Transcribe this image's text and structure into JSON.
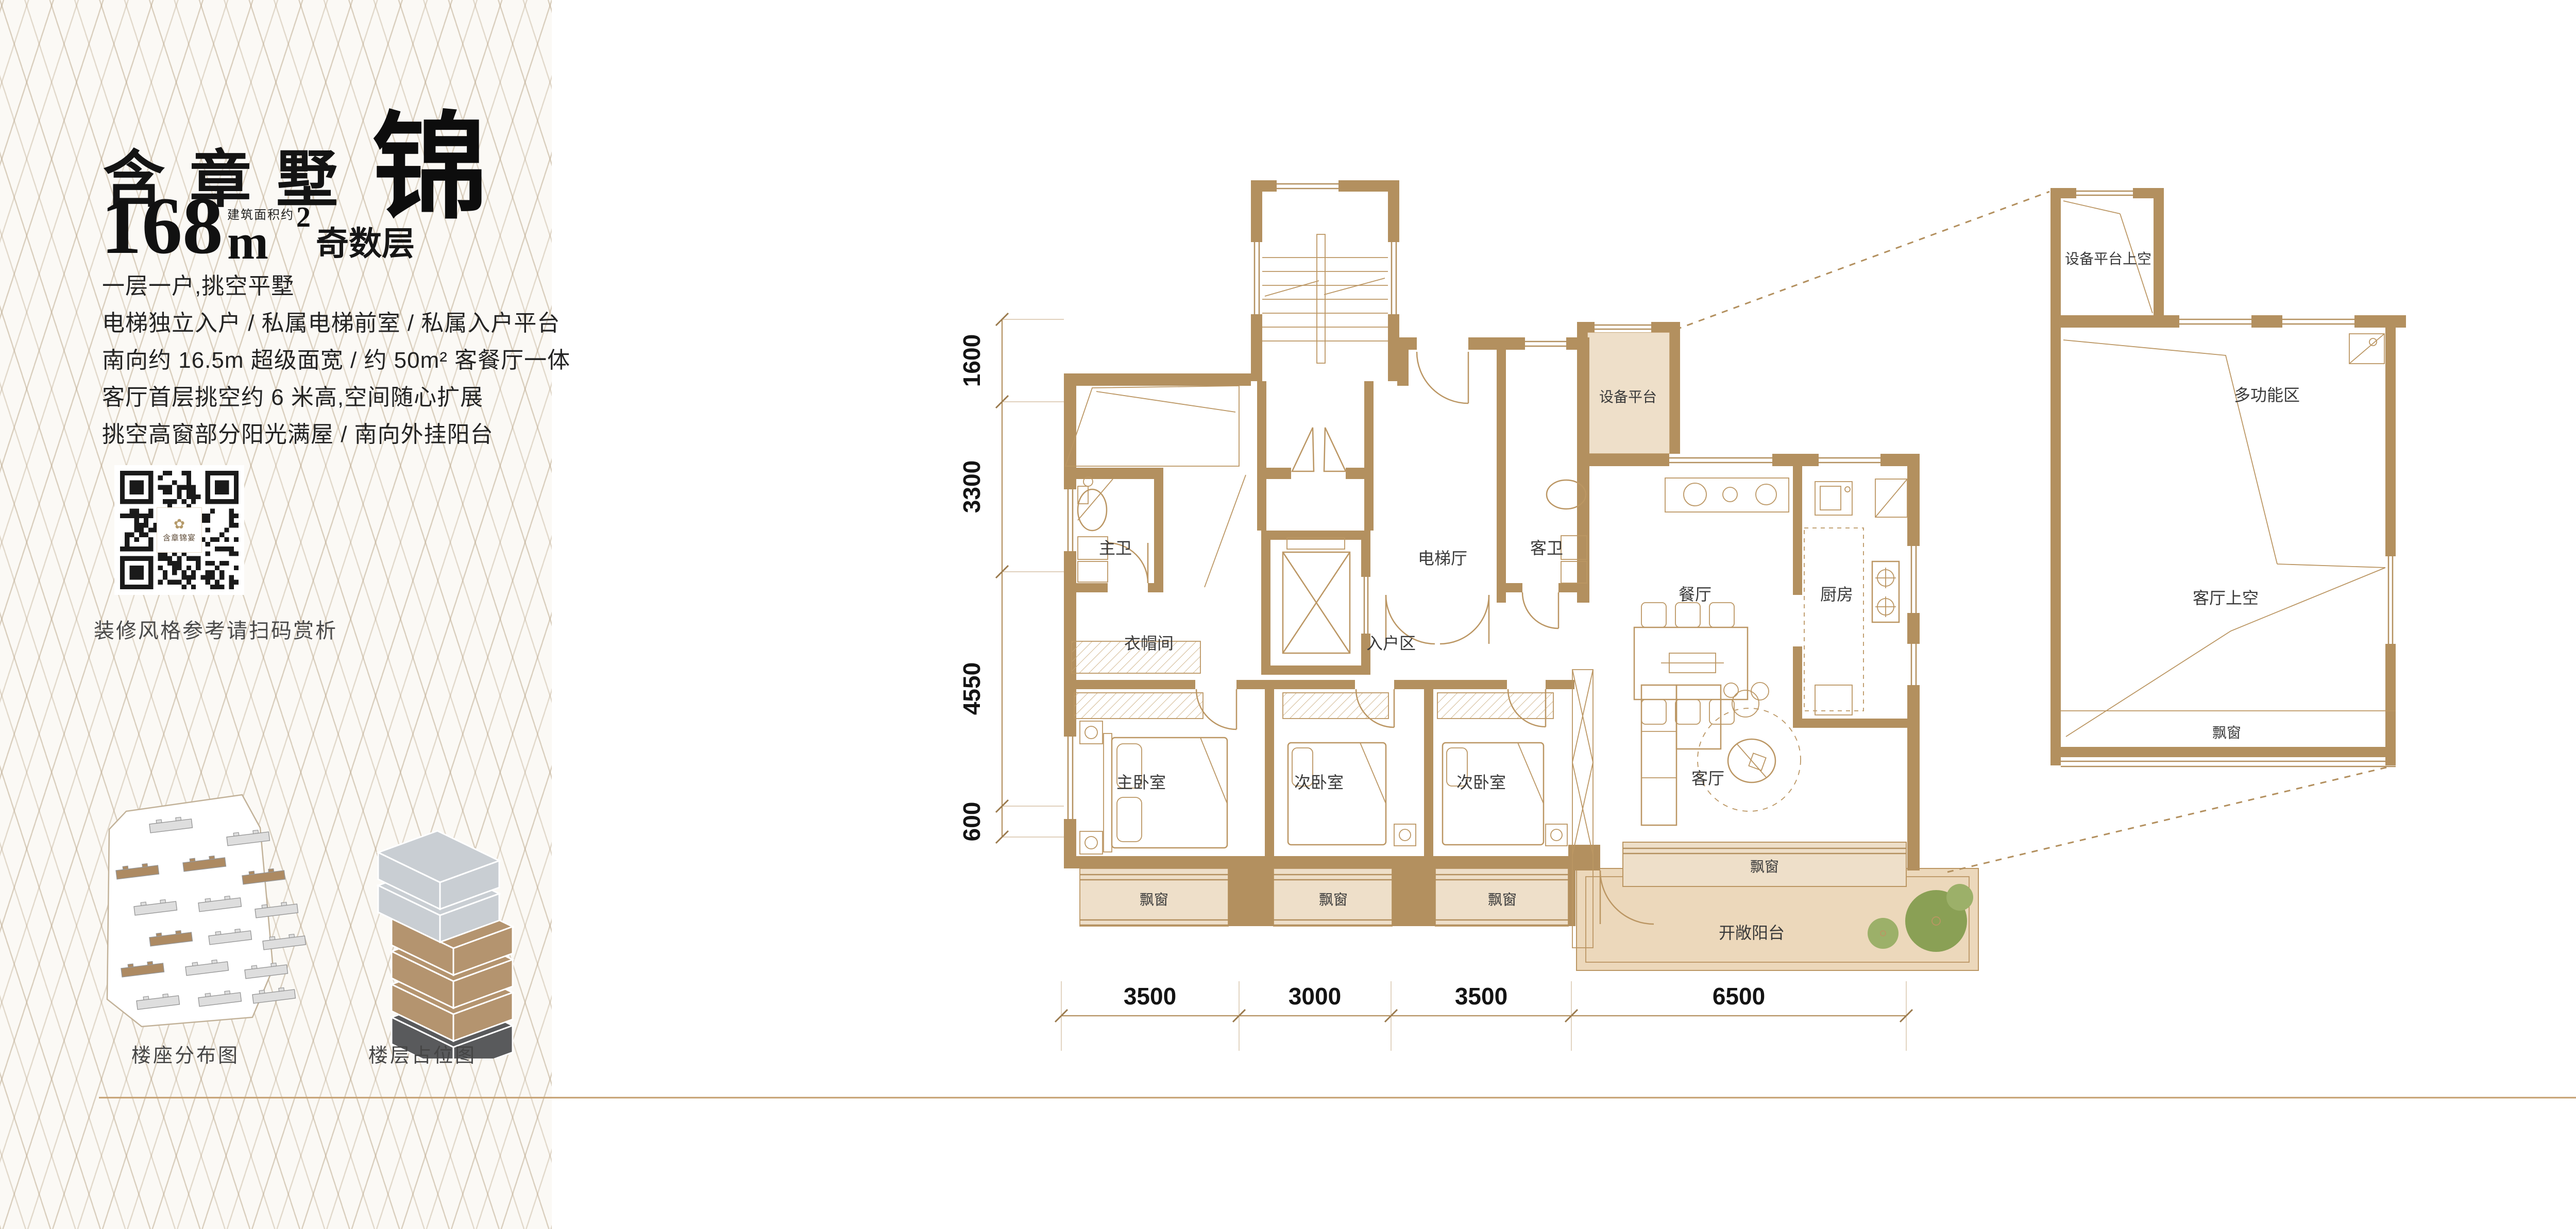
{
  "sidebar": {
    "title": {
      "main": "含章墅",
      "accent": "锦"
    },
    "area": {
      "number": "168",
      "unit": "m",
      "sup": "2",
      "note": "建筑面积约",
      "floor_type": "奇数层"
    },
    "features": [
      "一层一户,挑空平墅",
      "电梯独立入户 / 私属电梯前室 / 私属入户平台",
      "南向约 16.5m 超级面宽 / 约 50m² 客餐厅一体",
      "客厅首层挑空约 6 米高,空间随心扩展",
      "挑空高窗部分阳光满屋 / 南向外挂阳台"
    ],
    "qr_logo": "含章锦宴",
    "qr_caption": "装修风格参考请扫码赏析",
    "captions": {
      "site_plan": "楼座分布图",
      "stack_plan": "楼层占位图"
    }
  },
  "plan": {
    "labels": {
      "equipment_platform": "设备平台",
      "master_bath": "主卫",
      "elevator_hall": "电梯厅",
      "guest_bath": "客卫",
      "dining": "餐厅",
      "kitchen": "厨房",
      "cloakroom": "衣帽间",
      "entry_zone": "入户区",
      "master_bedroom": "主卧室",
      "second_bedroom": "次卧室",
      "living": "客厅",
      "bay_window": "飘窗",
      "open_balcony": "开敞阳台"
    },
    "dims_left": [
      "1600",
      "3300",
      "4550",
      "600"
    ],
    "dims_bottom": [
      "3500",
      "3000",
      "3500",
      "6500"
    ]
  },
  "detail_plan": {
    "labels": {
      "equipment_above": "设备平台上空",
      "multi_function": "多功能区",
      "living_above": "客厅上空",
      "bay_window": "飘窗"
    }
  },
  "legend": {
    "north": "N",
    "gift_area": "赠送面积"
  },
  "colors": {
    "wall": "#b3905f",
    "line": "#bb9663",
    "beige": "#eedfc9",
    "balcony": "#ecd8bb",
    "green": "#9cb069",
    "green_dark": "#8aa055",
    "accent_line": "#c49e6e",
    "stack_gray": "#c9ced3",
    "stack_tan": "#b4946f",
    "stack_dark": "#595a5c",
    "qr": "#1a1a1a"
  }
}
